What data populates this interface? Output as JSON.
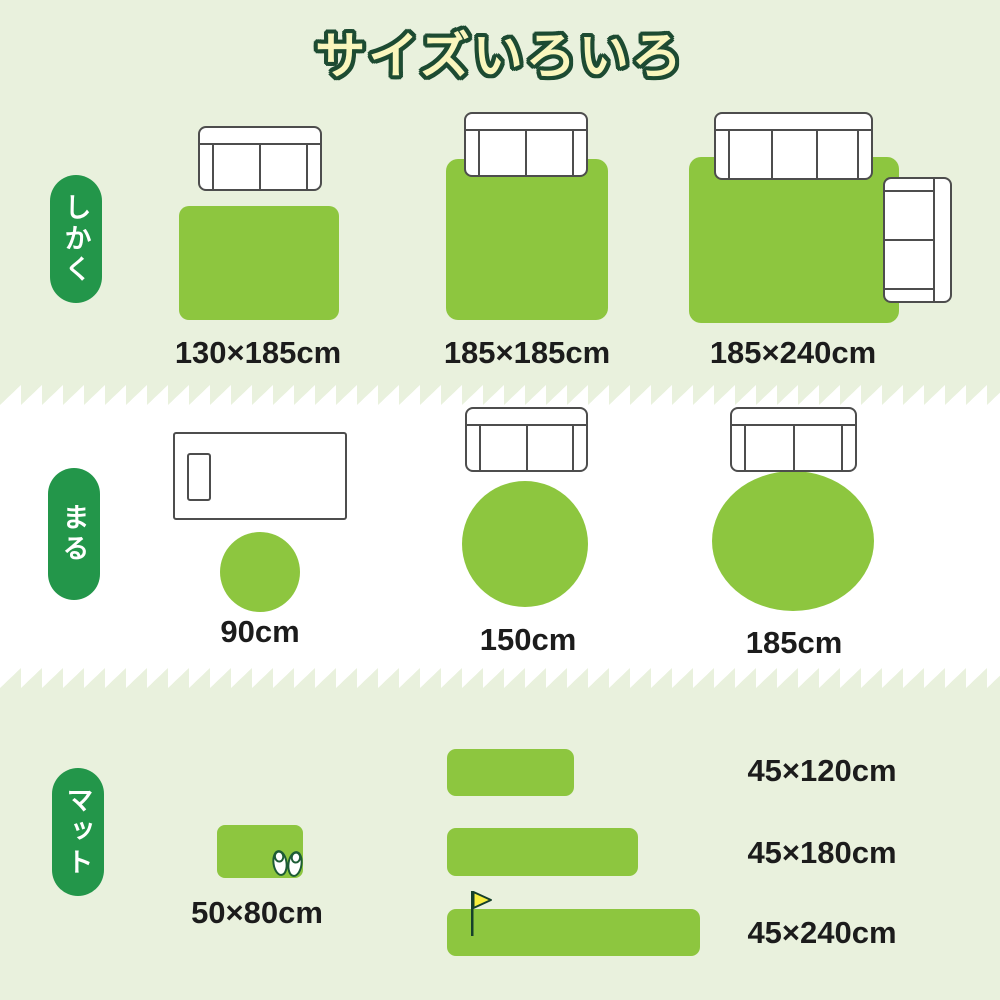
{
  "title": "サイズいろいろ",
  "colors": {
    "section_background": "#e9f1dd",
    "middle_background": "#ffffff",
    "rug_green": "#8dc63f",
    "pill_green": "#23964a",
    "title_fill": "#f9f6bd",
    "title_outline": "#1d4b32",
    "label_text": "#1c1c1c",
    "furniture_outline": "#4d4d4d",
    "flag_yellow": "#f7ee3f"
  },
  "sections": {
    "shikaku": {
      "label": "しかく",
      "items": [
        {
          "size": "130×185cm"
        },
        {
          "size": "185×185cm"
        },
        {
          "size": "185×240cm"
        }
      ]
    },
    "maru": {
      "label": "まる",
      "items": [
        {
          "size": "90cm"
        },
        {
          "size": "150cm"
        },
        {
          "size": "185cm"
        }
      ]
    },
    "mat": {
      "label": "マット",
      "items": [
        {
          "size": "50×80cm"
        },
        {
          "size": "45×120cm"
        },
        {
          "size": "45×180cm"
        },
        {
          "size": "45×240cm"
        }
      ]
    }
  }
}
